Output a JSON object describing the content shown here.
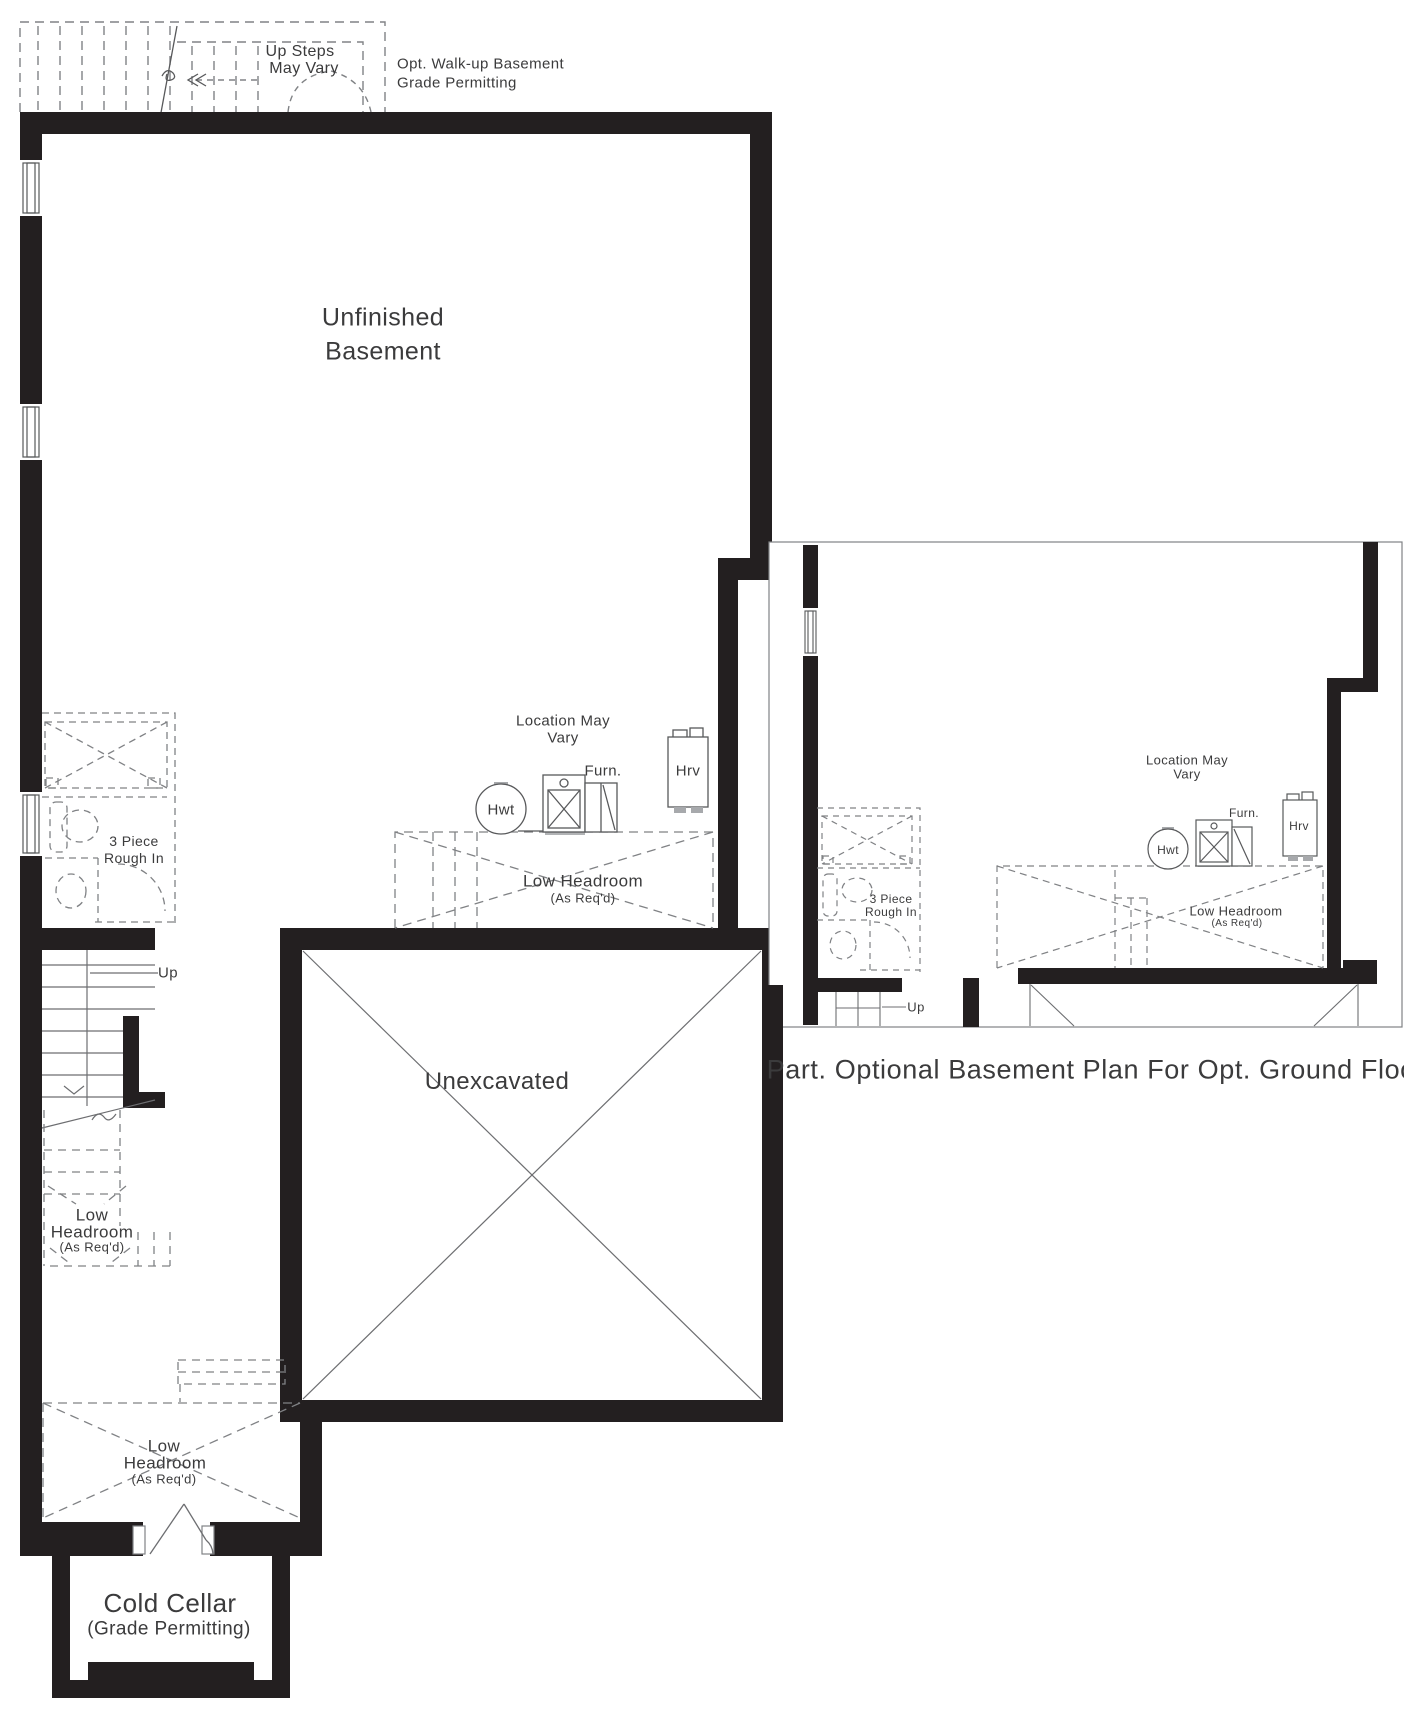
{
  "colors": {
    "wall": "#231f20",
    "thin_line": "#58595b",
    "dashed_line": "#808285",
    "text": "#3b3b3c"
  },
  "main_plan": {
    "walkup_stairs_note": {
      "line1": "Up Steps",
      "line2": "May Vary"
    },
    "walkup_note": {
      "line1": "Opt. Walk-up Basement",
      "line2": "Grade Permitting"
    },
    "room_label": {
      "line1": "Unfinished",
      "line2": "Basement"
    },
    "location_note": {
      "line1": "Location May",
      "line2": "Vary"
    },
    "equipment": {
      "hwt": "Hwt",
      "furn": "Furn.",
      "hrv": "Hrv"
    },
    "low_headroom_mid": {
      "line1": "Low Headroom",
      "line2": "(As Req'd)"
    },
    "rough_in": {
      "line1": "3 Piece",
      "line2": "Rough In"
    },
    "up_label": "Up",
    "stair_low_headroom": {
      "line1": "Low",
      "line2": "Headroom",
      "line3": "(As Req'd)"
    },
    "unexcavated_label": "Unexcavated",
    "cellar_low_headroom": {
      "line1": "Low",
      "line2": "Headroom",
      "line3": "(As Req'd)"
    },
    "cold_cellar": {
      "line1": "Cold Cellar",
      "line2": "(Grade Permitting)"
    }
  },
  "optional_plan": {
    "caption": "Part. Optional Basement Plan For Opt. Ground Floor",
    "location_note": {
      "line1": "Location May",
      "line2": "Vary"
    },
    "equipment": {
      "hwt": "Hwt",
      "furn": "Furn.",
      "hrv": "Hrv"
    },
    "rough_in": {
      "line1": "3 Piece",
      "line2": "Rough In"
    },
    "low_headroom": {
      "line1": "Low Headroom",
      "line2": "(As Req'd)"
    },
    "up_label": "Up"
  }
}
